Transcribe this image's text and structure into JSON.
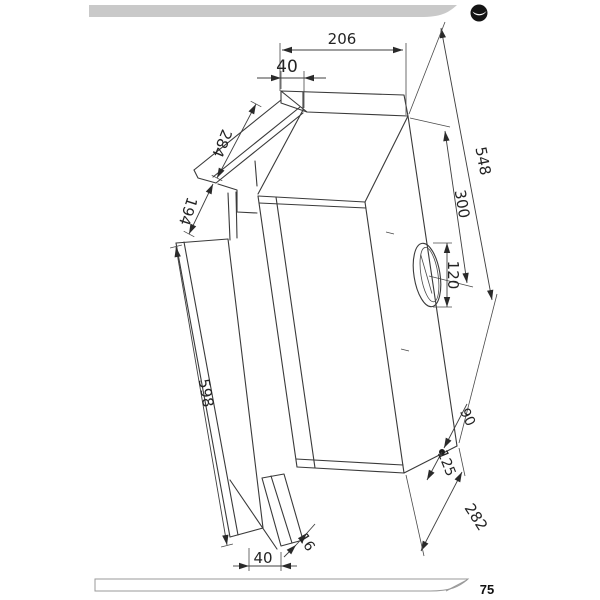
{
  "page": {
    "number": "75"
  },
  "header": {
    "logo": "swoosh-logo"
  },
  "colors": {
    "line": "#3a3a3a",
    "header_bar": "#c9c9c9",
    "logo": "#141414",
    "footer_stroke": "#9a9a9a"
  },
  "drawing": {
    "type": "technical-drawing",
    "subject": "telescopic built-in cooker hood installation dimensions",
    "units": "mm",
    "dimensions": {
      "duct_top_width": "206",
      "duct_front_depth": "40",
      "top_bracket_depth": "284",
      "front_bracket_depth": "194",
      "front_panel_height": "598",
      "body_height": "548",
      "outlet_center_from_top": "300",
      "outlet_diameter": "120",
      "keyhole_offset_back": "90",
      "keyhole_offset_bottom": "125",
      "body_bottom_depth": "282",
      "bottom_lip_offset": "16",
      "bottom_front_width": "40"
    }
  }
}
